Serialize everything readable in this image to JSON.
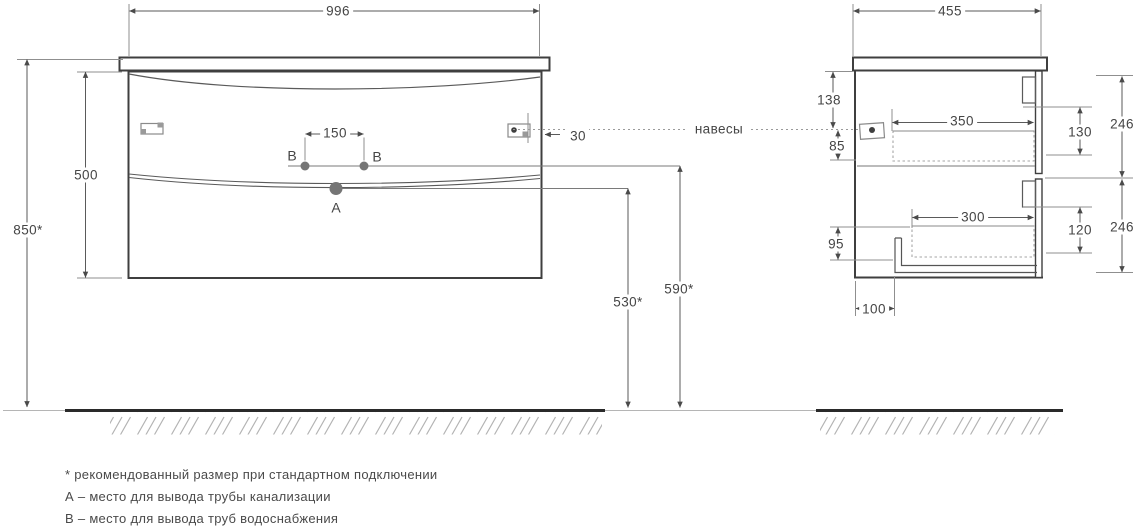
{
  "front_view": {
    "width": "996",
    "cabinet_height": "500",
    "mounting_height": "850*",
    "holes_spacing": "150",
    "hanger_offset": "30",
    "drain_height": "530*",
    "supply_height": "590*",
    "point_a": "A",
    "point_b_left": "B",
    "point_b_right": "B"
  },
  "side_view": {
    "depth": "455",
    "top_to_hangers": "138",
    "hangers_to_box": "85",
    "upper_drawer_depth": "350",
    "upper_drawer_height": "130",
    "upper_front_height": "246",
    "lower_drawer_depth": "300",
    "lower_drawer_height": "120",
    "lower_front_height": "246",
    "lower_clearance": "95",
    "bottom_recess": "100"
  },
  "hangers_label": "навесы",
  "notes": {
    "recommended": "* рекомендованный размер при стандартном подключении",
    "point_a": "А – место для вывода трубы канализации",
    "point_b": "В – место для вывода труб водоснабжения"
  },
  "colors": {
    "outline": "#3f3f3f",
    "dimension": "#5a5a5a",
    "dashed": "#a6a6a6",
    "dot": "#757575",
    "text": "#454545"
  }
}
